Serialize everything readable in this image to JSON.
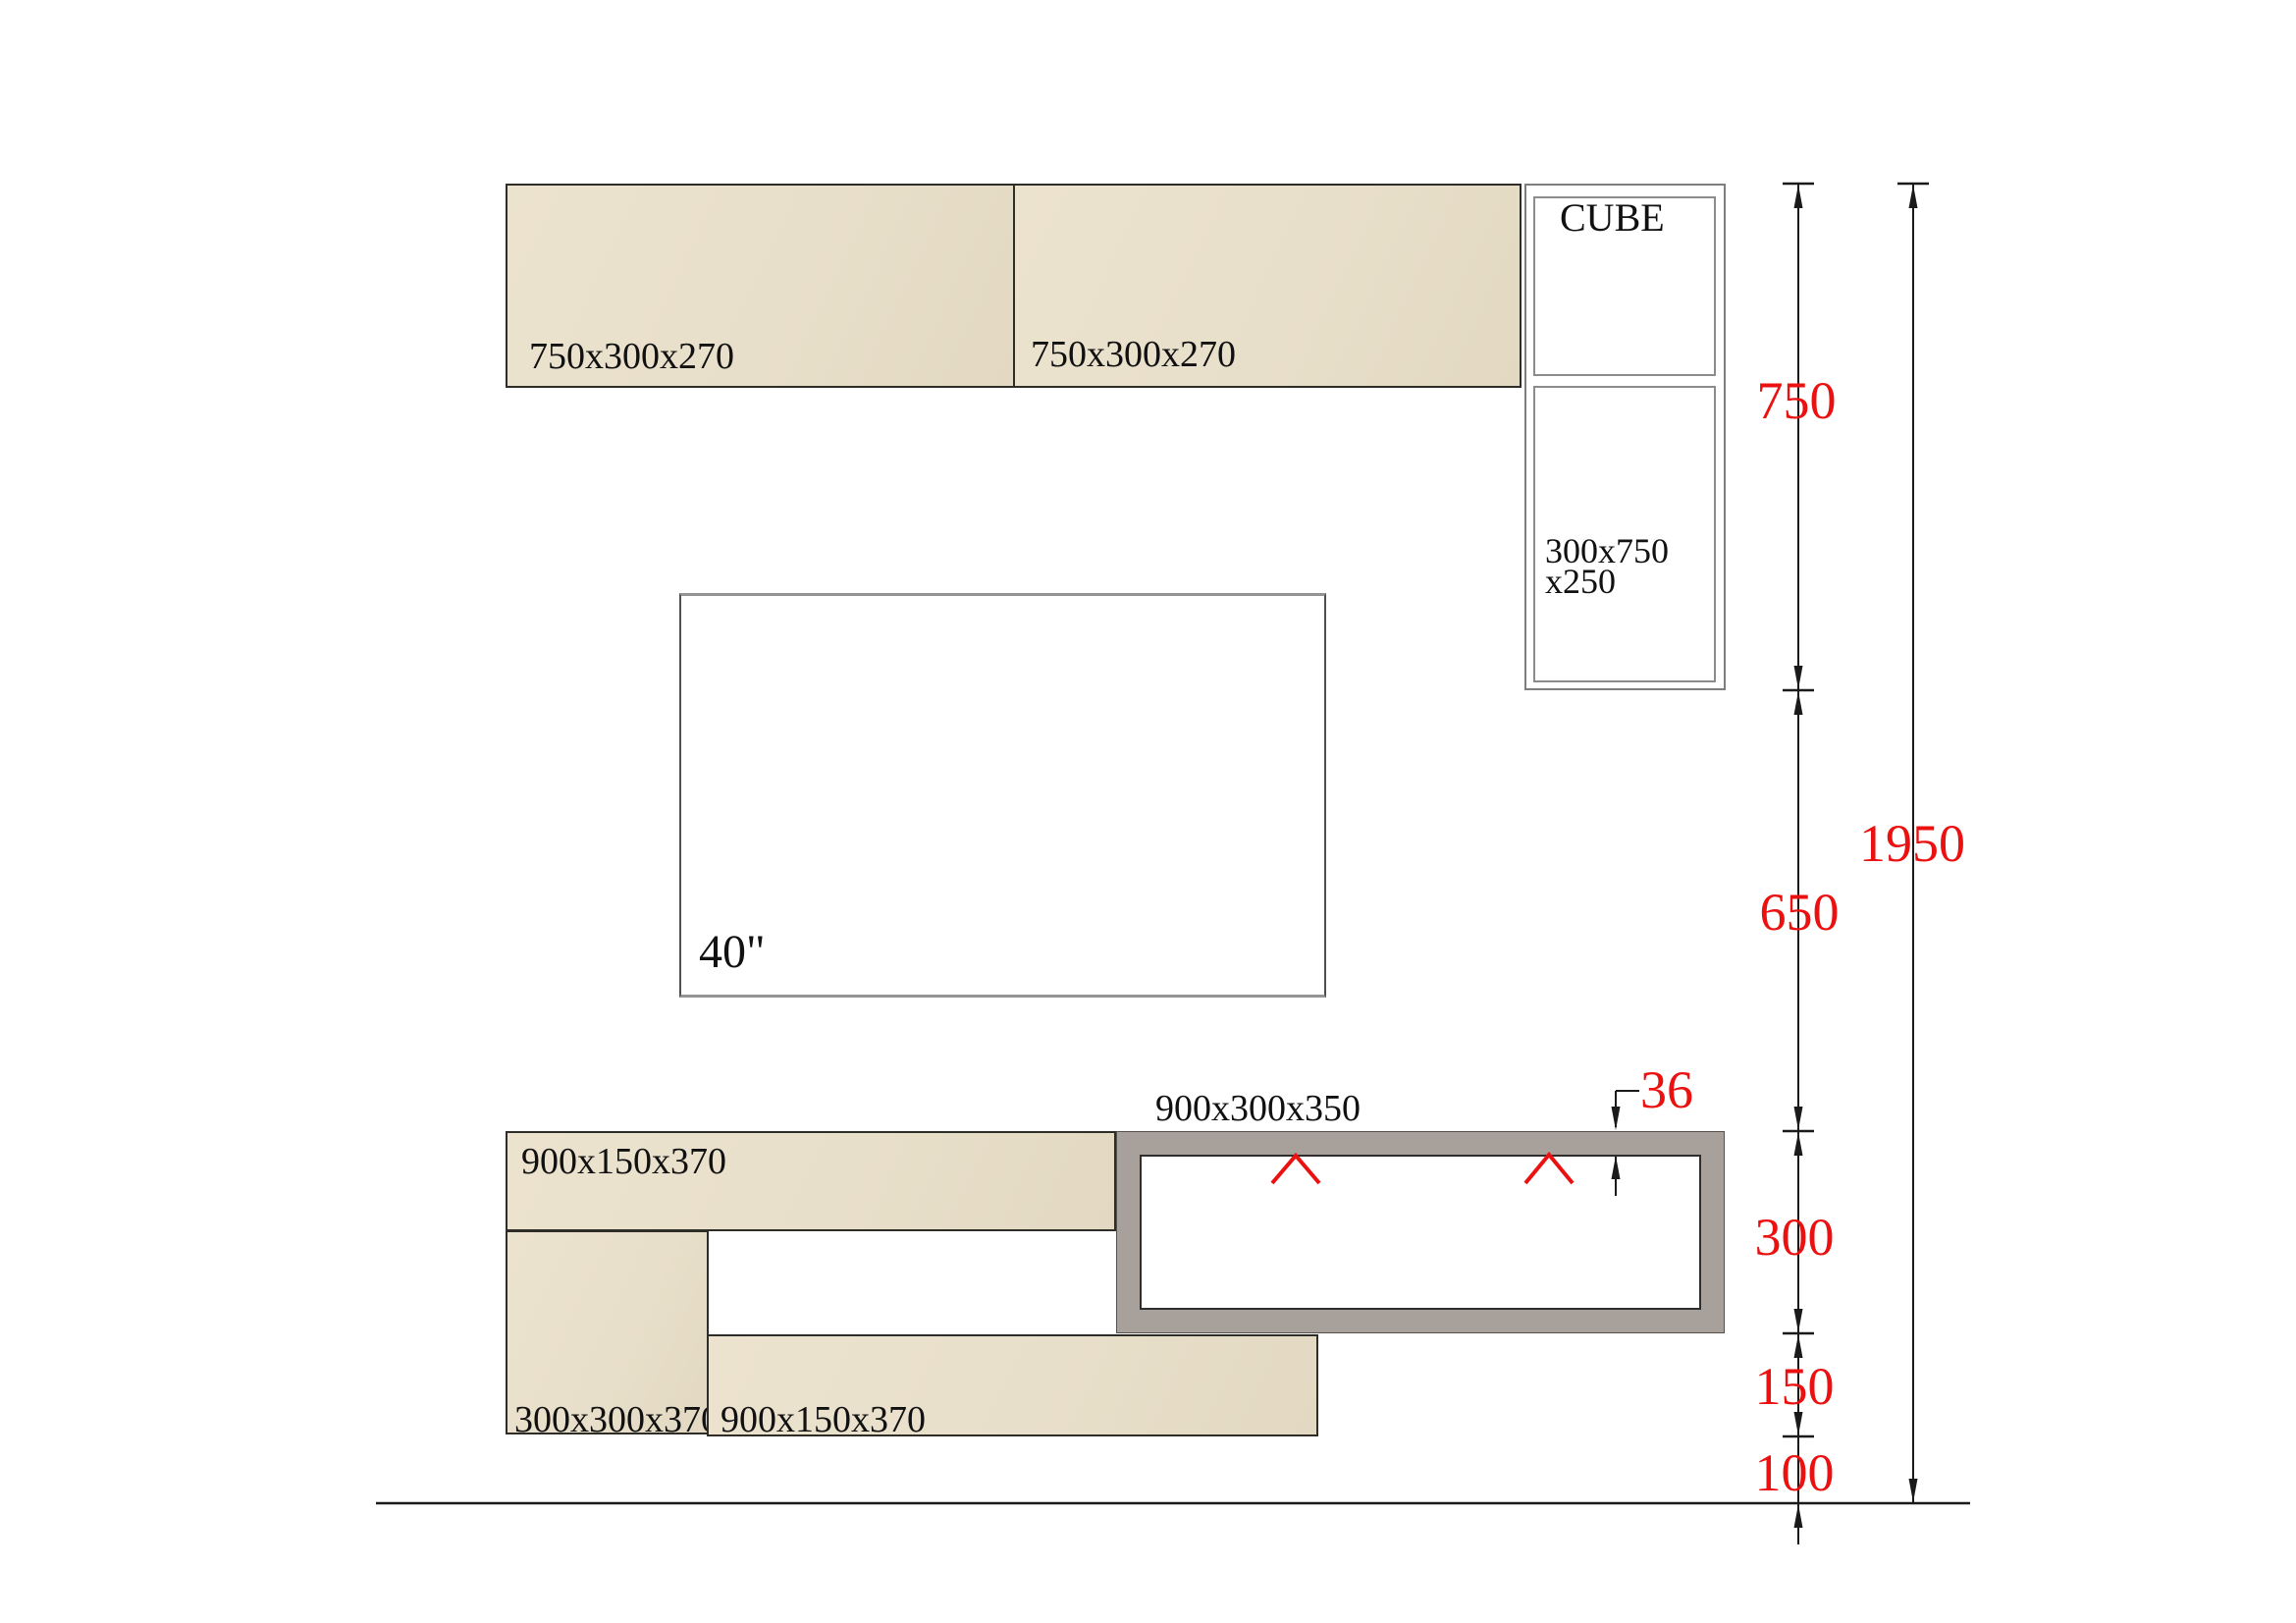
{
  "panels": {
    "left_label": "750x300x270",
    "right_label": "750x300x270"
  },
  "cube": {
    "title": "CUBE",
    "size_line1": "300x750",
    "size_line2": "x250"
  },
  "tv": {
    "label": "40\""
  },
  "base": {
    "top_shelf_label": "900x150x370",
    "left_column_label": "300x300x370",
    "bottom_shelf_label": "900x150x370",
    "media_box_label": "900x300x350"
  },
  "dimensions": {
    "cube_height": "750",
    "middle_gap": "650",
    "total_height": "1950",
    "media_height": "300",
    "shelf_gap": "150",
    "floor_gap": "100",
    "panel_thickness": "36"
  },
  "colors": {
    "beige": "#e8dfca",
    "frame_gray": "#a8a09b",
    "dimension_red": "#ec1111",
    "line_black": "#1a1a1a"
  }
}
